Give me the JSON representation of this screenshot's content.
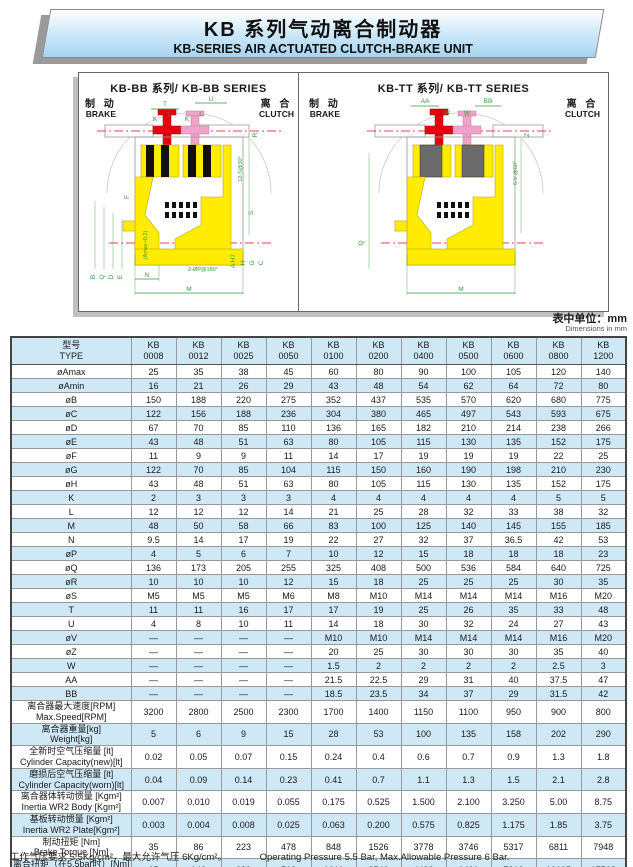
{
  "header": {
    "title_zh": "KB 系列气动离合制动器",
    "title_en": "KB-SERIES AIR ACTUATED CLUTCH-BRAKE UNIT"
  },
  "unit_note": {
    "zh": "表中单位：mm",
    "en": "Dimensions in mm"
  },
  "colors": {
    "body_yellow": "#ffec00",
    "brake_red": "#e60012",
    "clutch_pink": "#f0a3c8",
    "dim_green": "#2f9e38",
    "row_blue": "#cfe8f5"
  },
  "diagrams": {
    "bb": {
      "title": "KB-BB 系列/ KB-BB SERIES",
      "brake_zh": "制 动",
      "brake_en": "BRAKE",
      "clutch_zh": "离 合",
      "clutch_en": "CLUTCH",
      "dims": {
        "T": "T",
        "U": "U",
        "K": "K",
        "L": "L",
        "R": "R",
        "F": "F",
        "S": "S",
        "B": "B",
        "Q": "Q",
        "D": "D",
        "E": "E",
        "amax": "(Amax+0.2)",
        "N": "N",
        "M": "M",
        "ah7": "A H7",
        "H": "H",
        "G": "G",
        "C": "C",
        "p180": "2-ØP@180°",
        "s30": "12-S@30°"
      }
    },
    "tt": {
      "title": "KB-TT 系列/ KB-TT SERIES",
      "brake_zh": "制 动",
      "brake_en": "BRAKE",
      "clutch_zh": "离 合",
      "clutch_en": "CLUTCH",
      "dims": {
        "AA": "AA",
        "W": "W",
        "BB": "BB",
        "Z": "Z",
        "v60": "6-V @60°",
        "Q": "Q",
        "M": "M"
      }
    }
  },
  "table": {
    "type_zh": "型号",
    "type_en": "TYPE",
    "brand": "KB",
    "models": [
      "0008",
      "0012",
      "0025",
      "0050",
      "0100",
      "0200",
      "0400",
      "0500",
      "0600",
      "0800",
      "1200"
    ],
    "rows": [
      {
        "label": "øAmax",
        "values": [
          "25",
          "35",
          "38",
          "45",
          "60",
          "80",
          "90",
          "100",
          "105",
          "120",
          "140"
        ]
      },
      {
        "label": "øAmin",
        "values": [
          "16",
          "21",
          "26",
          "29",
          "43",
          "48",
          "54",
          "62",
          "64",
          "72",
          "80"
        ]
      },
      {
        "label": "øB",
        "values": [
          "150",
          "188",
          "220",
          "275",
          "352",
          "437",
          "535",
          "570",
          "620",
          "680",
          "775"
        ]
      },
      {
        "label": "øC",
        "values": [
          "122",
          "156",
          "188",
          "236",
          "304",
          "380",
          "465",
          "497",
          "543",
          "593",
          "675"
        ]
      },
      {
        "label": "øD",
        "values": [
          "67",
          "70",
          "85",
          "110",
          "136",
          "165",
          "182",
          "210",
          "214",
          "238",
          "266"
        ]
      },
      {
        "label": "øE",
        "values": [
          "43",
          "48",
          "51",
          "63",
          "80",
          "105",
          "115",
          "130",
          "135",
          "152",
          "175"
        ]
      },
      {
        "label": "øF",
        "values": [
          "11",
          "9",
          "9",
          "11",
          "14",
          "17",
          "19",
          "19",
          "19",
          "22",
          "25"
        ]
      },
      {
        "label": "øG",
        "values": [
          "122",
          "70",
          "85",
          "104",
          "115",
          "150",
          "160",
          "190",
          "198",
          "210",
          "230"
        ]
      },
      {
        "label": "øH",
        "values": [
          "43",
          "48",
          "51",
          "63",
          "80",
          "105",
          "115",
          "130",
          "135",
          "152",
          "175"
        ]
      },
      {
        "label": "K",
        "values": [
          "2",
          "3",
          "3",
          "3",
          "4",
          "4",
          "4",
          "4",
          "4",
          "5",
          "5"
        ]
      },
      {
        "label": "L",
        "values": [
          "12",
          "12",
          "12",
          "14",
          "21",
          "25",
          "28",
          "32",
          "33",
          "38",
          "32"
        ]
      },
      {
        "label": "M",
        "values": [
          "48",
          "50",
          "58",
          "66",
          "83",
          "100",
          "125",
          "140",
          "145",
          "155",
          "185"
        ]
      },
      {
        "label": "N",
        "values": [
          "9.5",
          "14",
          "17",
          "19",
          "22",
          "27",
          "32",
          "37",
          "36.5",
          "42",
          "53"
        ]
      },
      {
        "label": "øP",
        "values": [
          "4",
          "5",
          "6",
          "7",
          "10",
          "12",
          "15",
          "18",
          "18",
          "18",
          "23"
        ]
      },
      {
        "label": "øQ",
        "values": [
          "136",
          "173",
          "205",
          "255",
          "325",
          "408",
          "500",
          "536",
          "584",
          "640",
          "725"
        ]
      },
      {
        "label": "øR",
        "values": [
          "10",
          "10",
          "10",
          "12",
          "15",
          "18",
          "25",
          "25",
          "25",
          "30",
          "35"
        ]
      },
      {
        "label": "øS",
        "values": [
          "M5",
          "M5",
          "M5",
          "M6",
          "M8",
          "M10",
          "M14",
          "M14",
          "M14",
          "M16",
          "M20"
        ]
      },
      {
        "label": "T",
        "values": [
          "11",
          "11",
          "16",
          "17",
          "17",
          "19",
          "25",
          "26",
          "35",
          "33",
          "48"
        ]
      },
      {
        "label": "U",
        "values": [
          "4",
          "8",
          "10",
          "11",
          "14",
          "18",
          "30",
          "32",
          "24",
          "27",
          "43"
        ]
      },
      {
        "label": "øV",
        "values": [
          "—",
          "—",
          "—",
          "—",
          "M10",
          "M10",
          "M14",
          "M14",
          "M14",
          "M16",
          "M20"
        ]
      },
      {
        "label": "øZ",
        "values": [
          "—",
          "—",
          "—",
          "—",
          "20",
          "25",
          "30",
          "30",
          "30",
          "35",
          "40"
        ]
      },
      {
        "label": "W",
        "values": [
          "—",
          "—",
          "—",
          "—",
          "1.5",
          "2",
          "2",
          "2",
          "2",
          "2.5",
          "3"
        ]
      },
      {
        "label": "AA",
        "values": [
          "—",
          "—",
          "—",
          "—",
          "21.5",
          "22.5",
          "29",
          "31",
          "40",
          "37.5",
          "47"
        ]
      },
      {
        "label": "BB",
        "values": [
          "—",
          "—",
          "—",
          "—",
          "18.5",
          "23.5",
          "34",
          "37",
          "29",
          "31.5",
          "42"
        ]
      },
      {
        "label": "离合器最大速度[RPM]",
        "label2": "Max.Speed[RPM]",
        "values": [
          "3200",
          "2800",
          "2500",
          "2300",
          "1700",
          "1400",
          "1150",
          "1100",
          "950",
          "900",
          "800"
        ]
      },
      {
        "label": "离合器重量[kg]",
        "label2": "Weight[kg]",
        "values": [
          "5",
          "6",
          "9",
          "15",
          "28",
          "53",
          "100",
          "135",
          "158",
          "202",
          "290"
        ]
      },
      {
        "label": "全新时空气压缩量 [lt]",
        "label2": "Cylinder Capacity(new)[lt]",
        "values": [
          "0.02",
          "0.05",
          "0.07",
          "0.15",
          "0.24",
          "0.4",
          "0.6",
          "0.7",
          "0.9",
          "1.3",
          "1.8"
        ]
      },
      {
        "label": "磨损后空气压缩量 [lt]",
        "label2": "Cylinder Capacity(worn)[lt]",
        "values": [
          "0.04",
          "0.09",
          "0.14",
          "0.23",
          "0.41",
          "0.7",
          "1.1",
          "1.3",
          "1.5",
          "2.1",
          "2.8"
        ]
      },
      {
        "label": "离合器体转动惯量 [Kgm²]",
        "label2": "Inertia WR2 Body [Kgm²]",
        "values": [
          "0.007",
          "0.010",
          "0.019",
          "0.055",
          "0.175",
          "0.525",
          "1.500",
          "2.100",
          "3.250",
          "5.00",
          "8.75"
        ]
      },
      {
        "label": "基板转动惯量 [Kgm²]",
        "label2": "Inertia WR2 Plate[Kgm²]",
        "values": [
          "0.003",
          "0.004",
          "0.008",
          "0.025",
          "0.063",
          "0.200",
          "0.575",
          "0.825",
          "1.175",
          "1.85",
          "3.75"
        ]
      },
      {
        "label": "制动扭矩 [Nm]",
        "label2": "Brake Torque [Nm]",
        "values": [
          "35",
          "86",
          "223",
          "478",
          "848",
          "1526",
          "3778",
          "3746",
          "5317",
          "6811",
          "7948"
        ]
      },
      {
        "label": "离合扭矩（在5.5bar时）[Nm]",
        "label2": "Clutch Torque @ 5.5bar",
        "values": [
          "65",
          "143",
          "239",
          "516",
          "1011",
          "2543",
          "4499",
          "6401",
          "7312",
          "10105",
          "17568"
        ]
      }
    ]
  },
  "footer": {
    "zh": "工作气压要求 5.5Kg/cm²，最大允许气压 6Kg/cm²。",
    "en": "Operating Pressure 5.5 Bar, Max.Allowable Pressure 6 Bar."
  }
}
